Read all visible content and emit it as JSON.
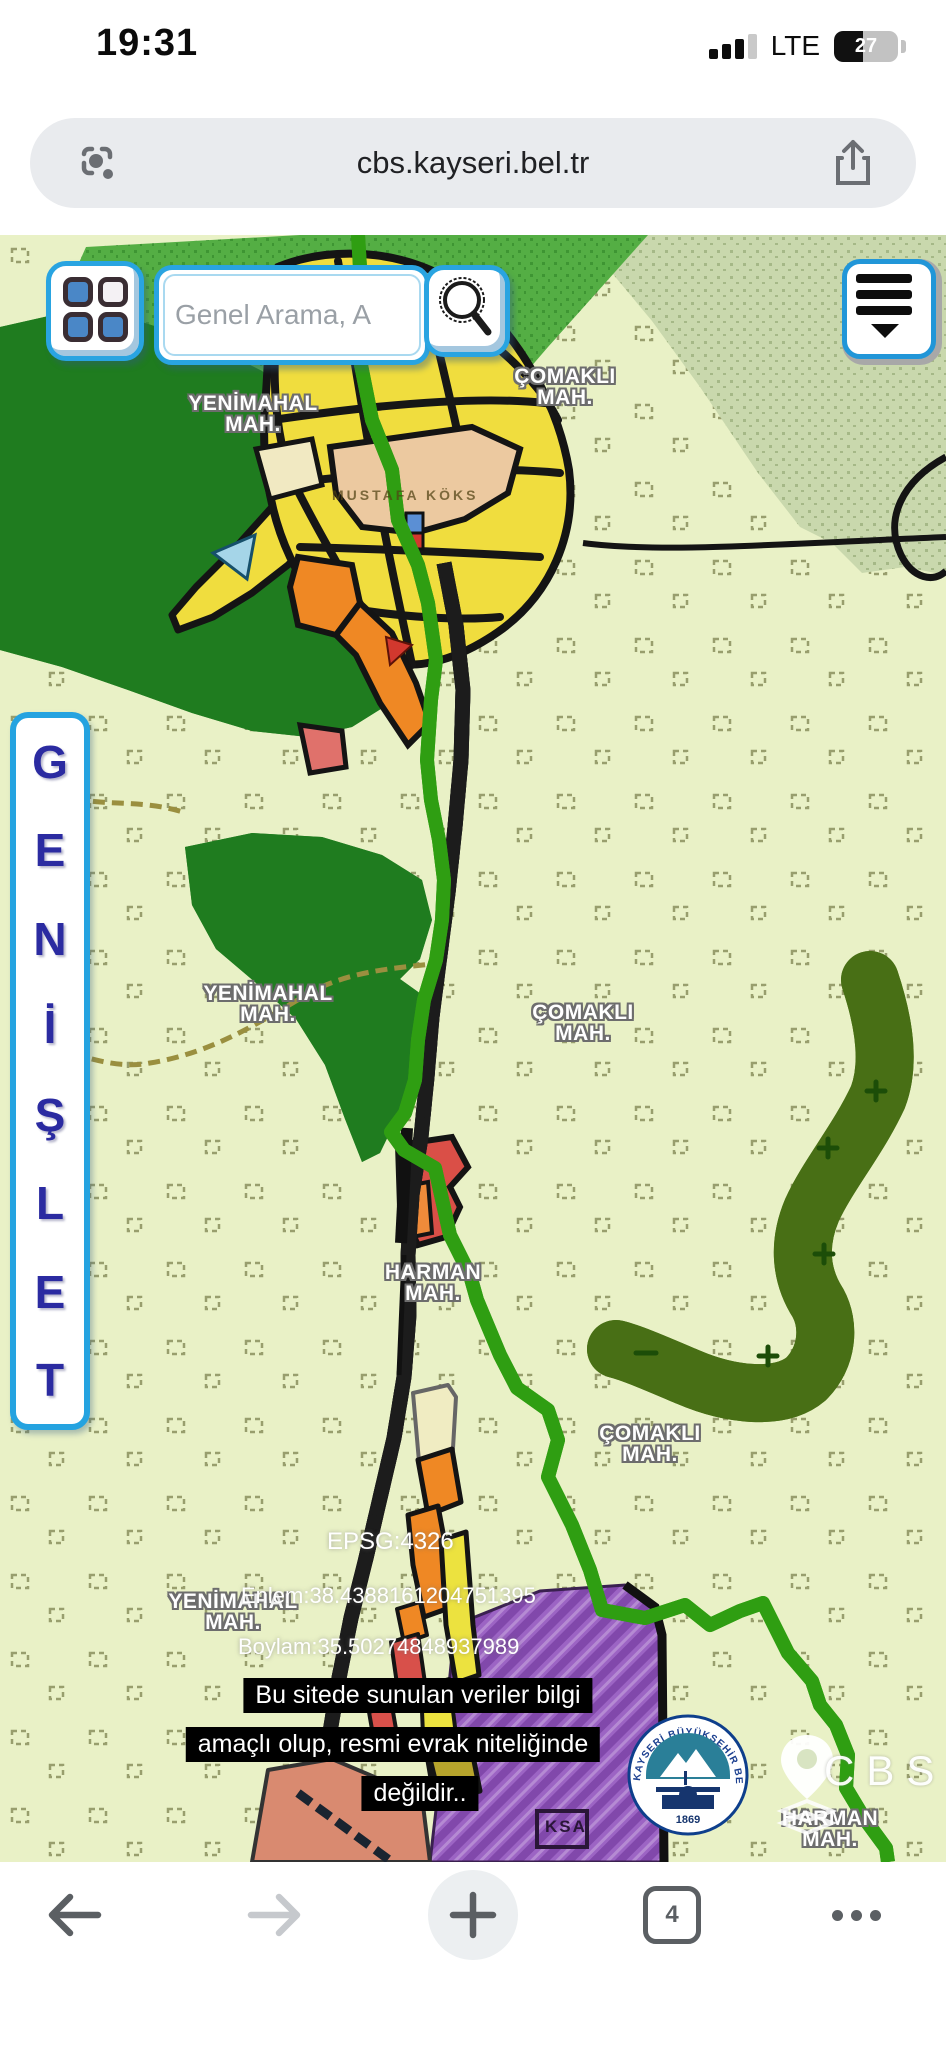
{
  "status_bar": {
    "time": "19:31",
    "network_label": "LTE",
    "battery_percent": "27"
  },
  "url_bar": {
    "url": "cbs.kayseri.bel.tr"
  },
  "toolbar": {
    "tab_count": "4"
  },
  "map_controls": {
    "search_placeholder": "Genel Arama, A",
    "expand_letters": [
      "G",
      "E",
      "N",
      "İ",
      "Ş",
      "L",
      "E",
      "T"
    ]
  },
  "map_labels": {
    "yenimahal_top": {
      "line1": "YENİMAHAL",
      "line2": "MAH."
    },
    "comakli_top": {
      "line1": "ÇOMAKLI",
      "line2": "MAH."
    },
    "yenimahal_mid": {
      "line1": "YENİMAHAL",
      "line2": "MAH."
    },
    "comakli_mid": {
      "line1": "ÇOMAKLI",
      "line2": "MAH."
    },
    "harman_mid": {
      "line1": "HARMAN",
      "line2": "MAH."
    },
    "comakli_bottom": {
      "line1": "ÇOMAKLI",
      "line2": "MAH."
    },
    "yenimahal_bottom": {
      "line1": "YENİMAHAL",
      "line2": "MAH."
    },
    "harman_bottom": {
      "line1": "HARMAN",
      "line2": "MAH."
    },
    "school_area": "MUSTAFA KÖKS",
    "parcel_code": "KSA"
  },
  "overlay": {
    "epsg": "EPSG:4326",
    "latitude": "Enlem:38.4388161204751395",
    "longitude": "Boylam:35.50274848937989",
    "disclaimer_line1": "Bu sitede sunulan veriler bilgi",
    "disclaimer_line2": "amaçlı olup, resmi evrak niteliğinde",
    "disclaimer_line3": "değildir..",
    "watermark": "CBS"
  },
  "logo": {
    "ring_text": "KAYSERİ BÜYÜKŞEHİR BELEDİYESİ",
    "year": "1869"
  },
  "colors": {
    "accent_blue": "#29a4e1",
    "navy": "#2b2ba1",
    "lime_boundary": "#55e02a",
    "forest_green": "#1f7c1f",
    "zone_yellow": "#f0dd3e",
    "zone_orange": "#ef8824",
    "zone_purple": "#9c64c4",
    "zone_red": "#da4f47"
  }
}
